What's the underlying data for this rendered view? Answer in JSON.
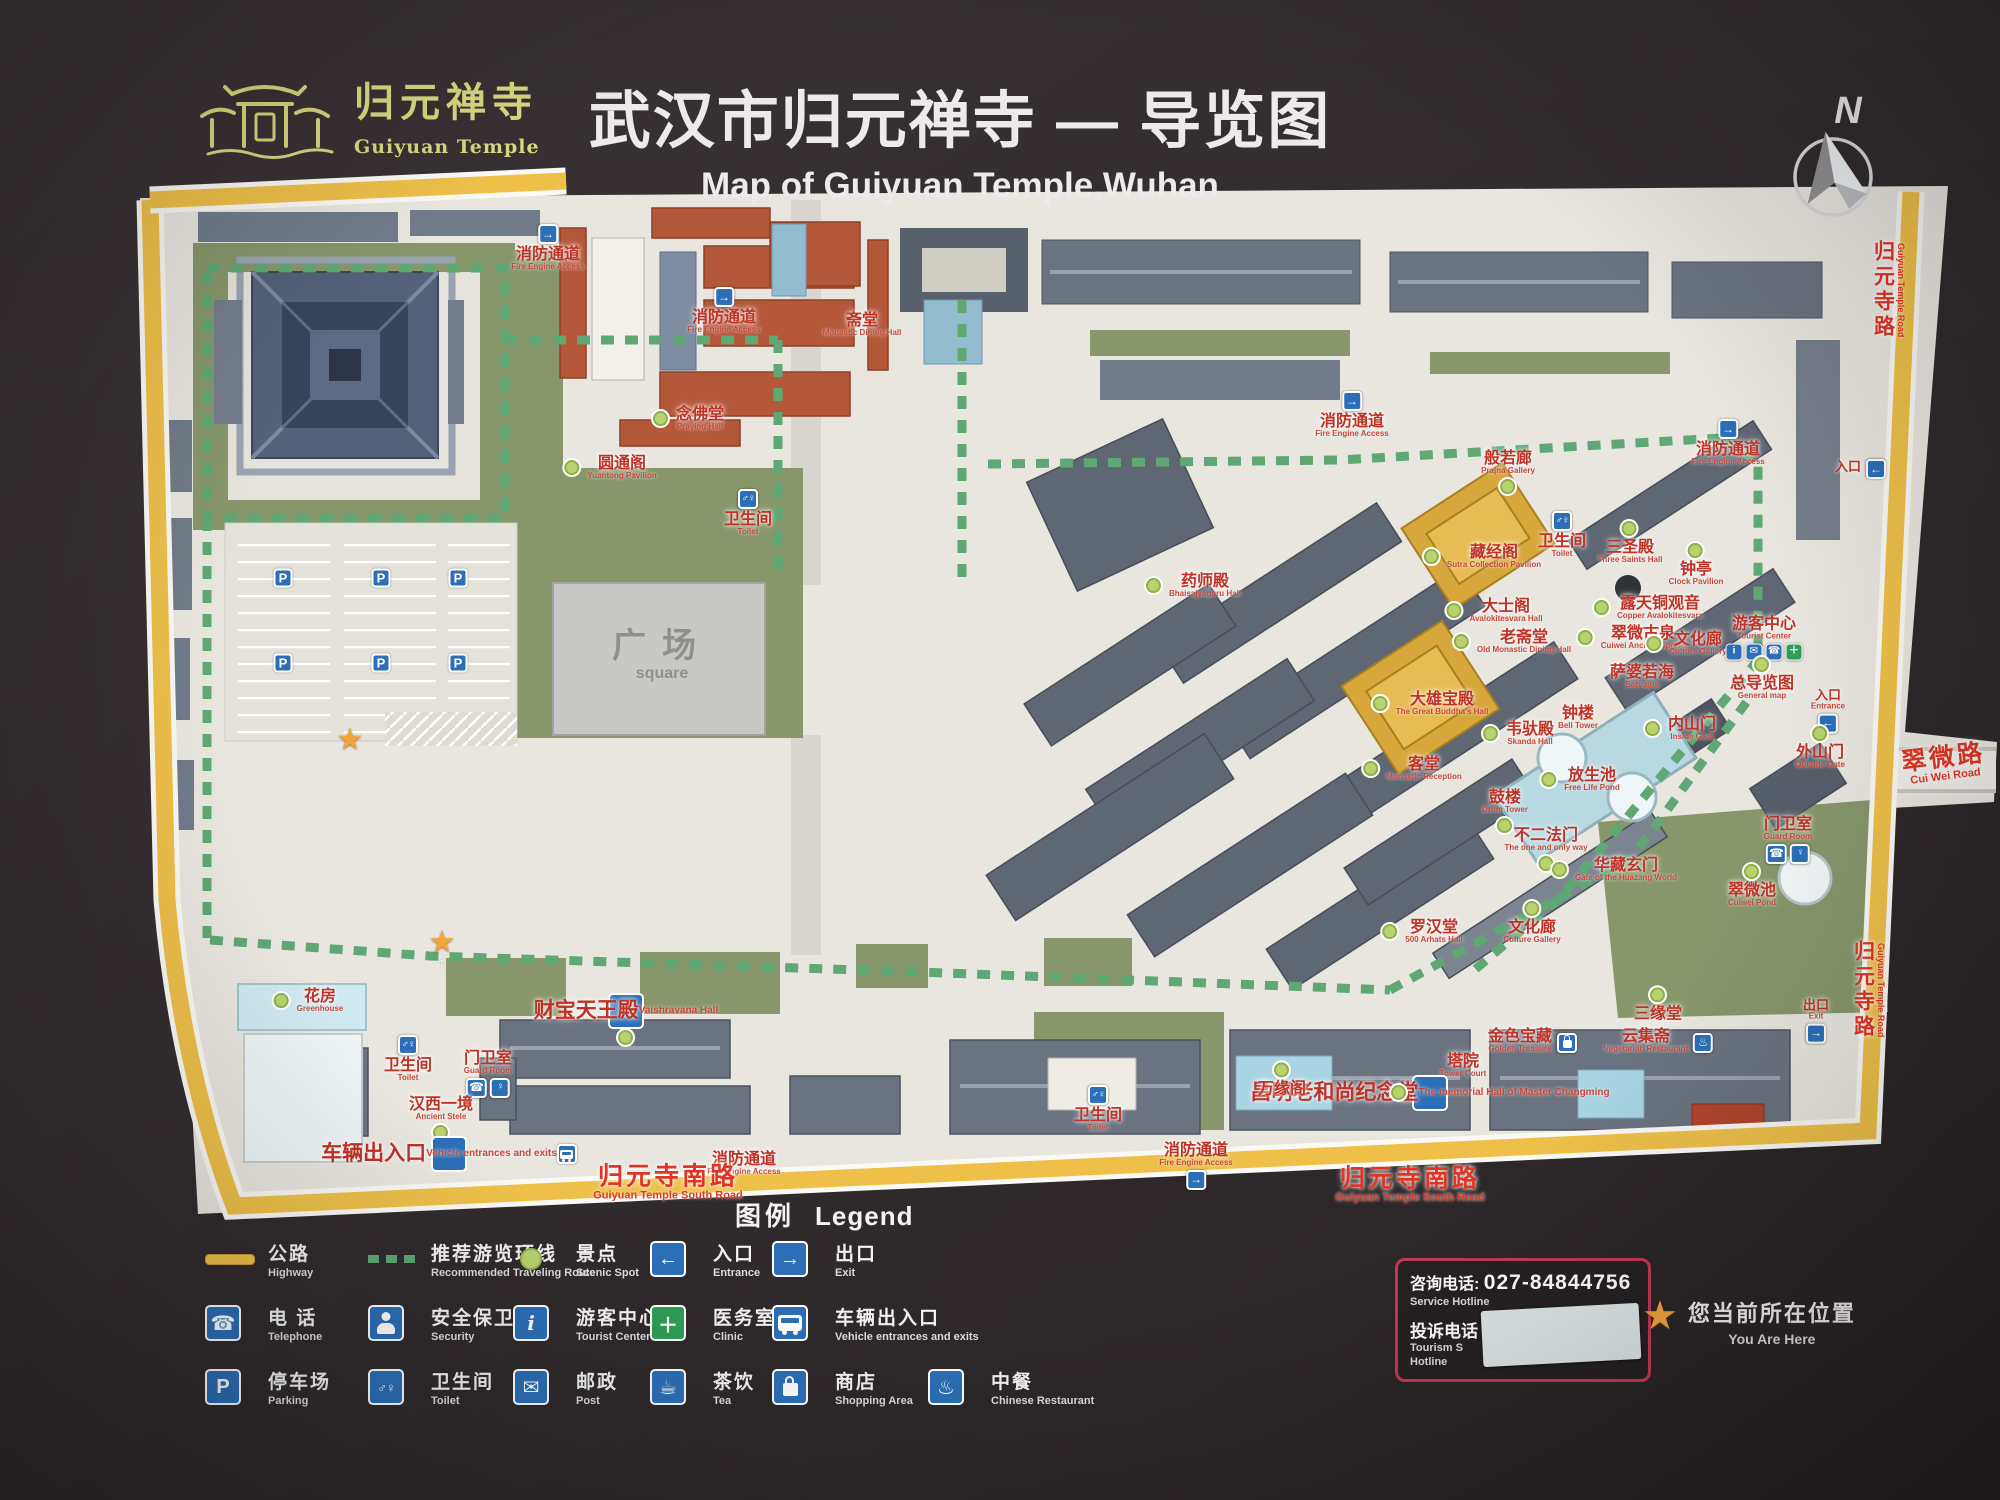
{
  "header": {
    "title_zh": "武汉市归元禅寺 — 导览图",
    "title_en": "Map of Guiyuan Temple,Wuhan",
    "logo_zh": "归元禅寺",
    "logo_en": "Guiyuan Temple"
  },
  "compass": {
    "label": "N"
  },
  "map": {
    "labels": [
      {
        "zh": "消防通道",
        "en": "Fire Engine Access",
        "x": 548,
        "y": 247,
        "icon": "fire",
        "ipos": "t"
      },
      {
        "zh": "斋堂",
        "en": "Monastic Dining Hall",
        "x": 862,
        "y": 325
      },
      {
        "zh": "消防通道",
        "en": "Fire Engine Access",
        "x": 724,
        "y": 310,
        "icon": "fire",
        "ipos": "t"
      },
      {
        "zh": "圆通阁",
        "en": "Yuantong Pavilion",
        "x": 622,
        "y": 468,
        "dot": "l"
      },
      {
        "zh": "念佛堂",
        "en": "Praying Hall",
        "x": 700,
        "y": 419,
        "dot": "l"
      },
      {
        "zh": "卫生间",
        "en": "Toilet",
        "x": 748,
        "y": 512,
        "icon": "toilet",
        "ipos": "t"
      },
      {
        "zh": "消防通道",
        "en": "Fire Engine Access",
        "x": 1352,
        "y": 414,
        "icon": "fire",
        "ipos": "t"
      },
      {
        "zh": "消防通道",
        "en": "Fire Engine Access",
        "x": 1728,
        "y": 442,
        "icon": "fire",
        "ipos": "t"
      },
      {
        "zh": "药师殿",
        "en": "Bhaisajyaguru Hall",
        "x": 1205,
        "y": 586,
        "dot": "l"
      },
      {
        "zh": "般若廊",
        "en": "Prajna Gallery",
        "x": 1508,
        "y": 463,
        "dot": "b"
      },
      {
        "zh": "藏经阁",
        "en": "Sutra Collection Pavilion",
        "x": 1494,
        "y": 557,
        "dot": "l"
      },
      {
        "zh": "卫生间",
        "en": "Toilet",
        "x": 1562,
        "y": 534,
        "icon": "toilet",
        "ipos": "t"
      },
      {
        "zh": "三圣殿",
        "en": "Three Saints Hall",
        "x": 1630,
        "y": 552,
        "dot": "t"
      },
      {
        "zh": "钟亭",
        "en": "Clock Pavilion",
        "x": 1696,
        "y": 574,
        "dot": "t"
      },
      {
        "zh": "大士阁",
        "en": "Avalokitesvara Hall",
        "x": 1506,
        "y": 611,
        "dot": "l"
      },
      {
        "zh": "露天铜观音",
        "en": "Copper Avalokitesvara",
        "x": 1660,
        "y": 608,
        "dot": "l"
      },
      {
        "zh": "老斋堂",
        "en": "Old Monastic Dining Hall",
        "x": 1524,
        "y": 642,
        "dot": "l"
      },
      {
        "zh": "翠微古泉",
        "en": "Cuiwei Ancient Spring",
        "x": 1643,
        "y": 638,
        "dot": "l"
      },
      {
        "zh": "文化廊",
        "en": "Culture Gallery",
        "x": 1698,
        "y": 644,
        "dot": "l"
      },
      {
        "zh": "游客中心",
        "en": "Tourist Center",
        "x": 1764,
        "y": 639,
        "icon": "tc",
        "ipos": "b"
      },
      {
        "zh": "萨婆若海",
        "en": "Sarvajna",
        "x": 1642,
        "y": 677
      },
      {
        "zh": "总导览图",
        "en": "General map",
        "x": 1762,
        "y": 688,
        "dot": "t"
      },
      {
        "zh": "钟楼",
        "en": "Bell Tower",
        "x": 1578,
        "y": 718
      },
      {
        "zh": "内山门",
        "en": "Inside Gate",
        "x": 1692,
        "y": 729,
        "dot": "l"
      },
      {
        "zh": "入口",
        "en": "Entrance",
        "x": 1828,
        "y": 712,
        "icon": "entrance",
        "ipos": "b",
        "cls": "sm"
      },
      {
        "zh": "外山门",
        "en": "Outside Gate",
        "x": 1820,
        "y": 757,
        "dot": "t"
      },
      {
        "zh": "大雄宝殿",
        "en": "The Great Buddha's Hall",
        "x": 1442,
        "y": 704,
        "dot": "l"
      },
      {
        "zh": "韦驮殿",
        "en": "Skanda Hall",
        "x": 1530,
        "y": 734,
        "dot": "l"
      },
      {
        "zh": "客堂",
        "en": "Monastic Reception",
        "x": 1424,
        "y": 769,
        "dot": "l"
      },
      {
        "zh": "放生池",
        "en": "Free Life Pond",
        "x": 1592,
        "y": 780,
        "dot": "l"
      },
      {
        "zh": "鼓楼",
        "en": "Drum Tower",
        "x": 1505,
        "y": 802,
        "dot": "b"
      },
      {
        "zh": "不二法门",
        "en": "The one and only way",
        "x": 1546,
        "y": 840,
        "dot": "b"
      },
      {
        "zh": "华藏玄门",
        "en": "Gate of the Huazang World",
        "x": 1626,
        "y": 870,
        "dot": "l"
      },
      {
        "zh": "罗汉堂",
        "en": "500 Arhats Hall",
        "x": 1434,
        "y": 932,
        "dot": "l"
      },
      {
        "zh": "文化廊",
        "en": "Culture Gallery",
        "x": 1532,
        "y": 932,
        "dot": "t"
      },
      {
        "zh": "翠微池",
        "en": "Cuiwei Pond",
        "x": 1752,
        "y": 895,
        "dot": "t"
      },
      {
        "zh": "门卫室",
        "en": "Guard Room",
        "x": 1788,
        "y": 841,
        "icon": "guard",
        "ipos": "b"
      },
      {
        "zh": "三缘堂",
        "en": "",
        "x": 1658,
        "y": 1014,
        "dot": "t"
      },
      {
        "zh": "金色宝藏",
        "en": "Golden Treasure",
        "x": 1520,
        "y": 1041,
        "icon": "shop",
        "ipos": "r"
      },
      {
        "zh": "云集斋",
        "en": "Vegetarian Restaurant",
        "x": 1646,
        "y": 1041,
        "icon": "restaurant",
        "ipos": "r"
      },
      {
        "zh": "塔院",
        "en": "Tower Court",
        "x": 1463,
        "y": 1066
      },
      {
        "zh": "昌明老和尚纪念堂",
        "en": "The memorial Hall of Master Changming",
        "x": 1430,
        "y": 1093,
        "dot": "l",
        "cls": "lg"
      },
      {
        "zh": "出口",
        "en": "Exit",
        "x": 1816,
        "y": 1022,
        "icon": "exit",
        "ipos": "b",
        "cls": "sm"
      },
      {
        "zh": "万缘阁",
        "en": "",
        "x": 1282,
        "y": 1089,
        "dot": "t"
      },
      {
        "zh": "财宝天王殿",
        "en": "Vaishravana Hall",
        "x": 626,
        "y": 1011,
        "dot": "b",
        "cls": "lg"
      },
      {
        "zh": "花房",
        "en": "Greenhouse",
        "x": 320,
        "y": 1001,
        "dot": "l"
      },
      {
        "zh": "卫生间",
        "en": "Toilet",
        "x": 408,
        "y": 1058,
        "icon": "toilet",
        "ipos": "t"
      },
      {
        "zh": "门卫室",
        "en": "Guard Room",
        "x": 488,
        "y": 1075,
        "icon": "guard",
        "ipos": "b"
      },
      {
        "zh": "汉西一境",
        "en": "Ancient Stele",
        "x": 441,
        "y": 1109,
        "dot": "b"
      },
      {
        "zh": "车辆出入口",
        "en": "Vehicle entrances and exits",
        "x": 449,
        "y": 1154,
        "icon": "vehicle",
        "ipos": "b",
        "cls": "lg"
      },
      {
        "zh": "消防通道",
        "en": "Fire Engine Access",
        "x": 744,
        "y": 1164
      },
      {
        "zh": "归元寺南路",
        "en": "Guiyuan Temple South Road",
        "x": 668,
        "y": 1183,
        "cls": "road"
      },
      {
        "zh": "卫生间",
        "en": "Toilet",
        "x": 1098,
        "y": 1108,
        "icon": "toilet",
        "ipos": "t"
      },
      {
        "zh": "消防通道",
        "en": "Fire Engine Access",
        "x": 1196,
        "y": 1167,
        "icon": "fire",
        "ipos": "b"
      },
      {
        "zh": "归元寺南路",
        "en": "Guiyuan Temple South Road",
        "x": 1410,
        "y": 1185,
        "cls": "road"
      },
      {
        "zh": "广场",
        "en": "square",
        "x": 662,
        "y": 655,
        "cls": "sq"
      },
      {
        "zh": "归元寺路",
        "en": "Guiyuan Temple Road",
        "x": 1888,
        "y": 290,
        "cls": "roadv"
      },
      {
        "zh": "翠微路",
        "en": "Cui Wei Road",
        "x": 1944,
        "y": 764,
        "cls": "road",
        "rot": -7
      },
      {
        "zh": "归元寺路",
        "en": "Guiyuan Temple Road",
        "x": 1868,
        "y": 990,
        "cls": "roadv"
      },
      {
        "zh": "入口",
        "en": "",
        "x": 1848,
        "y": 467,
        "cls": "sm",
        "icon": "entrance",
        "ipos": "r"
      }
    ],
    "p_markers": [
      {
        "x": 283,
        "y": 578
      },
      {
        "x": 381,
        "y": 578
      },
      {
        "x": 458,
        "y": 578
      },
      {
        "x": 283,
        "y": 663
      },
      {
        "x": 381,
        "y": 663
      },
      {
        "x": 458,
        "y": 663
      }
    ],
    "stars": [
      {
        "x": 350,
        "y": 740
      },
      {
        "x": 442,
        "y": 947,
        "arrow": true
      }
    ]
  },
  "legend": {
    "title_zh": "图例",
    "title_en": "Legend",
    "columns": [
      {
        "x": 205,
        "items": [
          {
            "icon": "highway",
            "zh": "公路",
            "en": "Highway"
          },
          {
            "icon": "telephone",
            "zh": "电 话",
            "en": "Telephone"
          },
          {
            "icon": "parking",
            "zh": "停车场",
            "en": "Parking"
          }
        ]
      },
      {
        "x": 368,
        "items": [
          {
            "icon": "route",
            "zh": "推荐游览环线",
            "en": "Recommended Traveling Route"
          },
          {
            "icon": "security",
            "zh": "安全保卫",
            "en": "Security"
          },
          {
            "icon": "toilet",
            "zh": "卫生间",
            "en": "Toilet"
          }
        ]
      },
      {
        "x": 513,
        "items": [
          {
            "icon": "spot",
            "zh": "景点",
            "en": "Scenic Spot"
          },
          {
            "icon": "tourist",
            "zh": "游客中心",
            "en": "Tourist Center"
          },
          {
            "icon": "post",
            "zh": "邮政",
            "en": "Post"
          }
        ]
      },
      {
        "x": 650,
        "items": [
          {
            "icon": "entrance",
            "zh": "入口",
            "en": "Entrance"
          },
          {
            "icon": "clinic",
            "zh": "医务室",
            "en": "Clinic"
          },
          {
            "icon": "tea",
            "zh": "茶饮",
            "en": "Tea"
          }
        ]
      },
      {
        "x": 772,
        "items": [
          {
            "icon": "exit",
            "zh": "出口",
            "en": "Exit"
          },
          {
            "icon": "vehicle",
            "zh": "车辆出入口",
            "en": "Vehicle entrances and exits"
          },
          {
            "icon": "shopping",
            "zh": "商店",
            "en": "Shopping Area"
          }
        ]
      },
      {
        "x": 928,
        "items": [
          null,
          null,
          {
            "icon": "restaurant",
            "zh": "中餐",
            "en": "Chinese Restaurant"
          }
        ]
      }
    ]
  },
  "hotline": {
    "label1": "咨询电话:",
    "number": "027-84844756",
    "en1": "Service Hotline",
    "label2": "投诉电话",
    "en2a": "Tourism S",
    "en2b": "Hotline"
  },
  "you_are_here": {
    "zh": "您当前所在位置",
    "en": "You Are Here"
  }
}
